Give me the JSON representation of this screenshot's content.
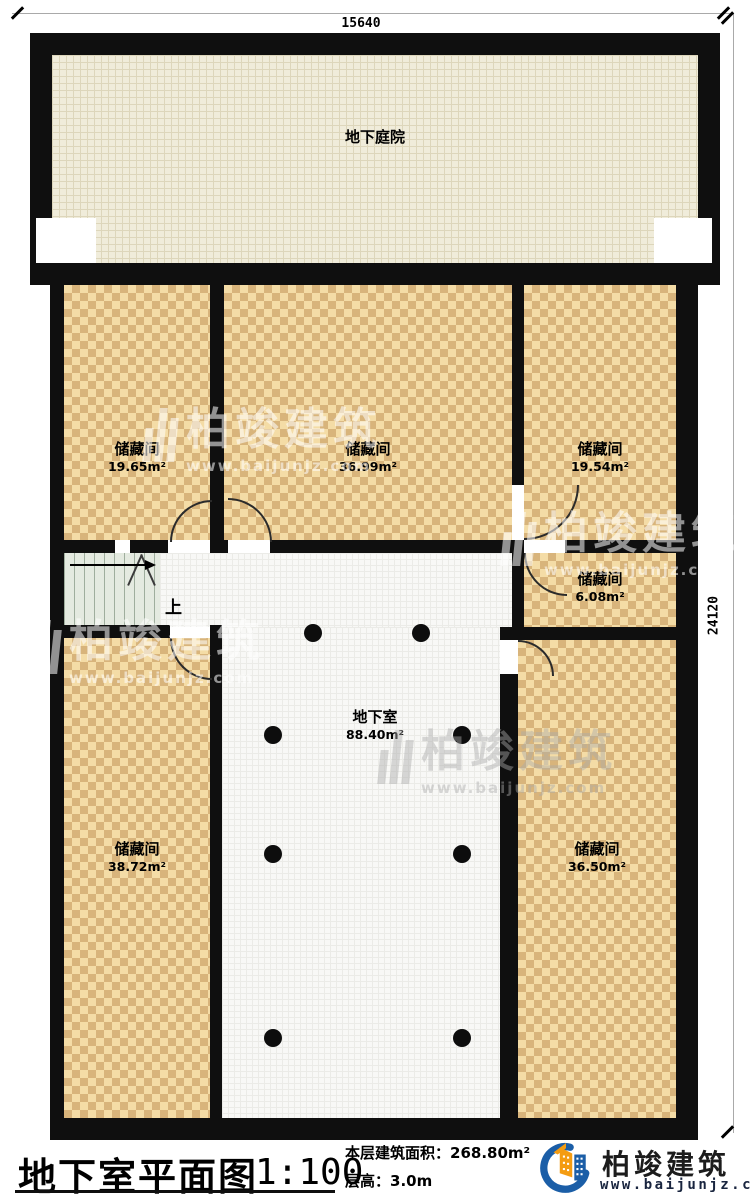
{
  "plan": {
    "dimensions": {
      "top": "15640",
      "right": "24120"
    },
    "rooms": [
      {
        "id": "courtyard",
        "name": "地下庭院",
        "area": ""
      },
      {
        "id": "storage-nw",
        "name": "储藏间",
        "area": "19.65m²"
      },
      {
        "id": "storage-n",
        "name": "储藏间",
        "area": "36.99m²"
      },
      {
        "id": "storage-ne",
        "name": "储藏间",
        "area": "19.54m²"
      },
      {
        "id": "storage-e",
        "name": "储藏间",
        "area": "6.08m²"
      },
      {
        "id": "basement",
        "name": "地下室",
        "area": "88.40m²"
      },
      {
        "id": "storage-sw",
        "name": "储藏间",
        "area": "38.72m²"
      },
      {
        "id": "storage-se",
        "name": "储藏间",
        "area": "36.50m²"
      }
    ],
    "stairs": {
      "up_label": "上"
    }
  },
  "footer": {
    "title": "地下室平面图",
    "scale": "1:100",
    "floor_area_label": "本层建筑面积：",
    "floor_area_value": "268.80m²",
    "floor_height_label": "层高：",
    "floor_height_value": "3.0m"
  },
  "branding": {
    "company": "柏竣建筑",
    "website": "www.baijunjz.com"
  },
  "colors": {
    "wall": "#0f0f0f",
    "checker_light": "#f4dca6",
    "checker_dark": "#d8b47b",
    "courtyard_fill": "#f0ecda",
    "floor_fill": "#f8f8f6",
    "stair_fill": "#e4eae0",
    "logo_blue": "#1b5ea7",
    "logo_orange": "#f49c12"
  }
}
